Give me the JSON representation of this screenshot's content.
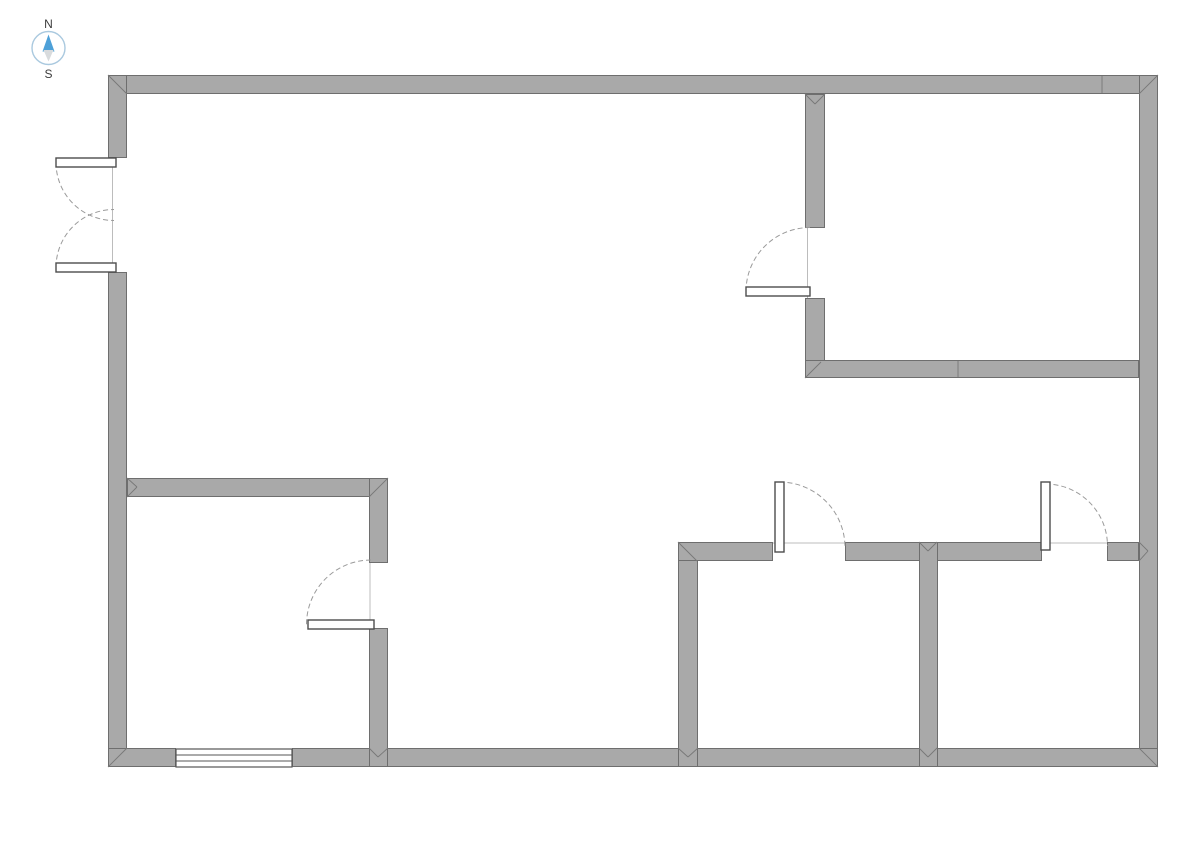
{
  "compass": {
    "north_label": "N",
    "south_label": "S",
    "cx": 48.5,
    "cy": 48,
    "radius": 16.5,
    "circle_color": "#aac9df",
    "north_arrow_color": "#4da0d8",
    "south_arrow_color": "#d8dbdd",
    "north_arrow_points": "48.5,34.5 42.5,51.5 54.5,51.5",
    "south_arrow_points": "48.5,61.5 43.5,50 53.5,50",
    "north_label_x": 48.5,
    "north_label_y": 28,
    "south_label_x": 48.5,
    "south_label_y": 78
  },
  "floorplan": {
    "palette": {
      "background": "#ffffff",
      "wall_fill": "#a9a9a9",
      "wall_outline": "#6e6e6e",
      "joint_line": "#787878",
      "door_panel_fill": "#ffffff",
      "door_panel_outline": "#4d4d4d",
      "door_arc": "#9a9a9a",
      "frame_line": "#bcbcbc",
      "window_fill": "#ffffff",
      "window_outline": "#555555"
    },
    "walls": [
      {
        "name": "exterior-wall-top",
        "x": 108,
        "y": 75,
        "w": 1050,
        "h": 19
      },
      {
        "name": "exterior-wall-left-upper",
        "x": 108,
        "y": 75,
        "w": 19,
        "h": 83
      },
      {
        "name": "exterior-wall-left-lower",
        "x": 108,
        "y": 272,
        "w": 19,
        "h": 495
      },
      {
        "name": "exterior-wall-right",
        "x": 1139,
        "y": 75,
        "w": 19,
        "h": 692
      },
      {
        "name": "exterior-wall-bottom-left",
        "x": 108,
        "y": 748,
        "w": 68,
        "h": 19
      },
      {
        "name": "exterior-wall-bottom-right",
        "x": 292,
        "y": 748,
        "w": 866,
        "h": 19
      },
      {
        "name": "top-right-room-wall-west-upper",
        "x": 805,
        "y": 94,
        "w": 20,
        "h": 134
      },
      {
        "name": "top-right-room-wall-west-lower",
        "x": 805,
        "y": 298,
        "w": 20,
        "h": 80
      },
      {
        "name": "top-right-room-wall-south",
        "x": 805,
        "y": 360,
        "w": 334,
        "h": 18
      },
      {
        "name": "bottom-left-room-wall-north",
        "x": 127,
        "y": 478,
        "w": 261,
        "h": 19
      },
      {
        "name": "bottom-left-room-wall-east-upper",
        "x": 369,
        "y": 478,
        "w": 19,
        "h": 85
      },
      {
        "name": "bottom-left-room-wall-east-lower",
        "x": 369,
        "y": 628,
        "w": 19,
        "h": 139
      },
      {
        "name": "bottom-middle-room-wall-west",
        "x": 678,
        "y": 542,
        "w": 20,
        "h": 225
      },
      {
        "name": "bottom-rooms-wall-north-seg1",
        "x": 678,
        "y": 542,
        "w": 95,
        "h": 19
      },
      {
        "name": "bottom-rooms-wall-north-seg2",
        "x": 845,
        "y": 542,
        "w": 197,
        "h": 19
      },
      {
        "name": "bottom-rooms-wall-north-seg3",
        "x": 1107,
        "y": 542,
        "w": 32,
        "h": 19
      },
      {
        "name": "bottom-rooms-dividing-wall",
        "x": 919,
        "y": 542,
        "w": 19,
        "h": 225
      }
    ],
    "joints": [
      {
        "name": "miter-top-left",
        "x1": 108,
        "y1": 75,
        "x2": 127,
        "y2": 94
      },
      {
        "name": "miter-top-right",
        "x1": 1158,
        "y1": 75,
        "x2": 1139,
        "y2": 94
      },
      {
        "name": "miter-bottom-left",
        "x1": 108,
        "y1": 767,
        "x2": 127,
        "y2": 748
      },
      {
        "name": "miter-bottom-right",
        "x1": 1158,
        "y1": 767,
        "x2": 1139,
        "y2": 748
      },
      {
        "name": "miter-tjoint-topwall-a",
        "x1": 805,
        "y1": 94,
        "x2": 815,
        "y2": 104
      },
      {
        "name": "miter-tjoint-topwall-b",
        "x1": 825,
        "y1": 94,
        "x2": 815,
        "y2": 104
      },
      {
        "name": "miter-topright-room-corner",
        "x1": 805,
        "y1": 378,
        "x2": 821,
        "y2": 362
      },
      {
        "name": "miter-leftwall-tjoint-a",
        "x1": 127,
        "y1": 478,
        "x2": 137,
        "y2": 487
      },
      {
        "name": "miter-leftwall-tjoint-b",
        "x1": 127,
        "y1": 497,
        "x2": 137,
        "y2": 487
      },
      {
        "name": "miter-bottomleft-room-corner",
        "x1": 388,
        "y1": 478,
        "x2": 369,
        "y2": 497
      },
      {
        "name": "miter-bottommiddle-room-corner",
        "x1": 678,
        "y1": 542,
        "x2": 697,
        "y2": 561
      },
      {
        "name": "miter-divider-tjoint-a",
        "x1": 919,
        "y1": 542,
        "x2": 928,
        "y2": 551
      },
      {
        "name": "miter-divider-tjoint-b",
        "x1": 937,
        "y1": 542,
        "x2": 928,
        "y2": 551
      },
      {
        "name": "miter-rightwall-tjoint-a",
        "x1": 1139,
        "y1": 542,
        "x2": 1148,
        "y2": 551
      },
      {
        "name": "miter-rightwall-tjoint-b",
        "x1": 1139,
        "y1": 561,
        "x2": 1148,
        "y2": 551
      },
      {
        "name": "miter-d-bottom-a",
        "x1": 369,
        "y1": 748,
        "x2": 378,
        "y2": 757
      },
      {
        "name": "miter-d-bottom-b",
        "x1": 388,
        "y1": 748,
        "x2": 378,
        "y2": 757
      },
      {
        "name": "miter-e-bottom-a",
        "x1": 678,
        "y1": 748,
        "x2": 688,
        "y2": 757
      },
      {
        "name": "miter-e-bottom-b",
        "x1": 698,
        "y1": 748,
        "x2": 688,
        "y2": 757
      },
      {
        "name": "miter-g-bottom-a",
        "x1": 919,
        "y1": 748,
        "x2": 928,
        "y2": 757
      },
      {
        "name": "miter-g-bottom-b",
        "x1": 937,
        "y1": 748,
        "x2": 928,
        "y2": 757
      },
      {
        "name": "seam-top-wall",
        "x1": 1102,
        "y1": 76,
        "x2": 1102,
        "y2": 93
      },
      {
        "name": "seam-topright-room-south-wall",
        "x1": 958,
        "y1": 361,
        "x2": 958,
        "y2": 377
      }
    ],
    "doors": [
      {
        "name": "entry-double-door",
        "type": "double",
        "frame_line": {
          "x1": 112.5,
          "y1": 162,
          "x2": 112.5,
          "y2": 268
        },
        "leaves": [
          {
            "panel": {
              "x": 56,
              "y": 158,
              "w": 60,
              "h": 9
            },
            "arc": "M 56 162.5 A 58 58 0 0 0 114 220.5"
          },
          {
            "panel": {
              "x": 56,
              "y": 263,
              "w": 60,
              "h": 9
            },
            "arc": "M 56 267.5 A 58 58 0 0 1 114 209.5"
          }
        ]
      },
      {
        "name": "top-right-room-door",
        "type": "single",
        "frame_line": {
          "x1": 807.5,
          "y1": 228,
          "x2": 807.5,
          "y2": 298
        },
        "leaves": [
          {
            "panel": {
              "x": 746,
              "y": 287,
              "w": 64,
              "h": 9
            },
            "arc": "M 746 291.5 A 64 64 0 0 1 810 227.5"
          }
        ]
      },
      {
        "name": "bottom-left-room-door",
        "type": "single",
        "frame_line": {
          "x1": 370,
          "y1": 563,
          "x2": 370,
          "y2": 624
        },
        "leaves": [
          {
            "panel": {
              "x": 308,
              "y": 620,
              "w": 66,
              "h": 9
            },
            "arc": "M 371 560 A 64.5 64.5 0 0 0 306.5 624.5"
          }
        ]
      },
      {
        "name": "bottom-middle-room-door",
        "type": "single",
        "frame_line": {
          "x1": 773,
          "y1": 543,
          "x2": 845,
          "y2": 543
        },
        "leaves": [
          {
            "panel": {
              "x": 775,
              "y": 482,
              "w": 9,
              "h": 70
            },
            "arc": "M 779.5 482 A 65.5 65.5 0 0 1 845 547.5"
          }
        ]
      },
      {
        "name": "bottom-right-room-door",
        "type": "single",
        "frame_line": {
          "x1": 1042,
          "y1": 543,
          "x2": 1107,
          "y2": 543
        },
        "leaves": [
          {
            "panel": {
              "x": 1041,
              "y": 482,
              "w": 9,
              "h": 68
            },
            "arc": "M 1045.5 484 A 62 62 0 0 1 1107.5 546"
          }
        ]
      }
    ],
    "windows": [
      {
        "name": "bottom-wall-window",
        "x": 176,
        "y": 749,
        "w": 116,
        "h": 18,
        "pane_lines": 2
      }
    ]
  }
}
